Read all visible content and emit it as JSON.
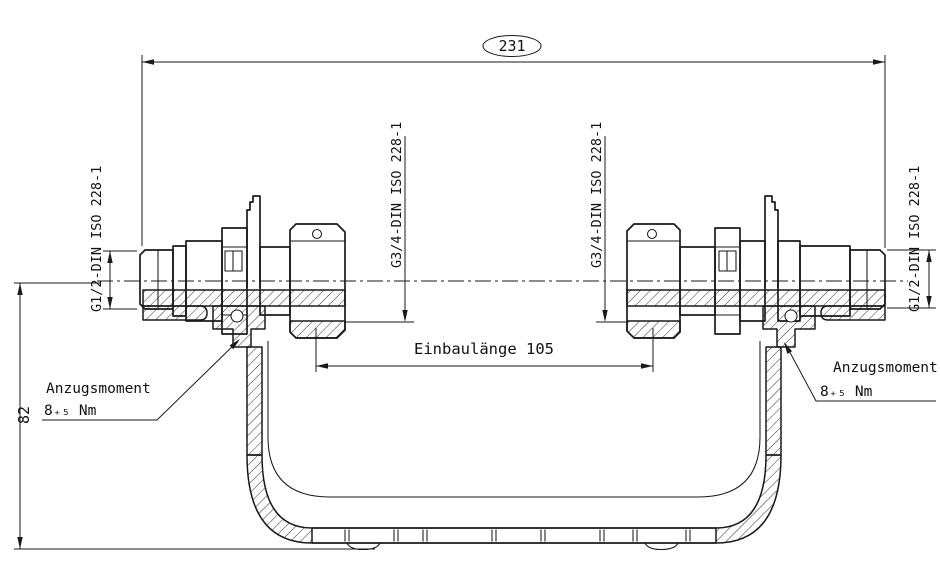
{
  "drawing": {
    "background": "#ffffff",
    "line_color": "#1a1a1a",
    "dimensions": {
      "overall_length": "231",
      "height": "82",
      "installation_length": "Einbaulänge 105"
    },
    "threads": {
      "left_outer": "G1/2-DIN ISO 228-1",
      "left_inner": "G3/4-DIN ISO 228-1",
      "right_inner": "G3/4-DIN ISO 228-1",
      "right_outer": "G1/2-DIN ISO 228-1"
    },
    "torque_left": {
      "label": "Anzugsmoment",
      "value": "8₊₅ Nm"
    },
    "torque_right": {
      "label": "Anzugsmoment",
      "value": "8₊₅ Nm"
    }
  }
}
